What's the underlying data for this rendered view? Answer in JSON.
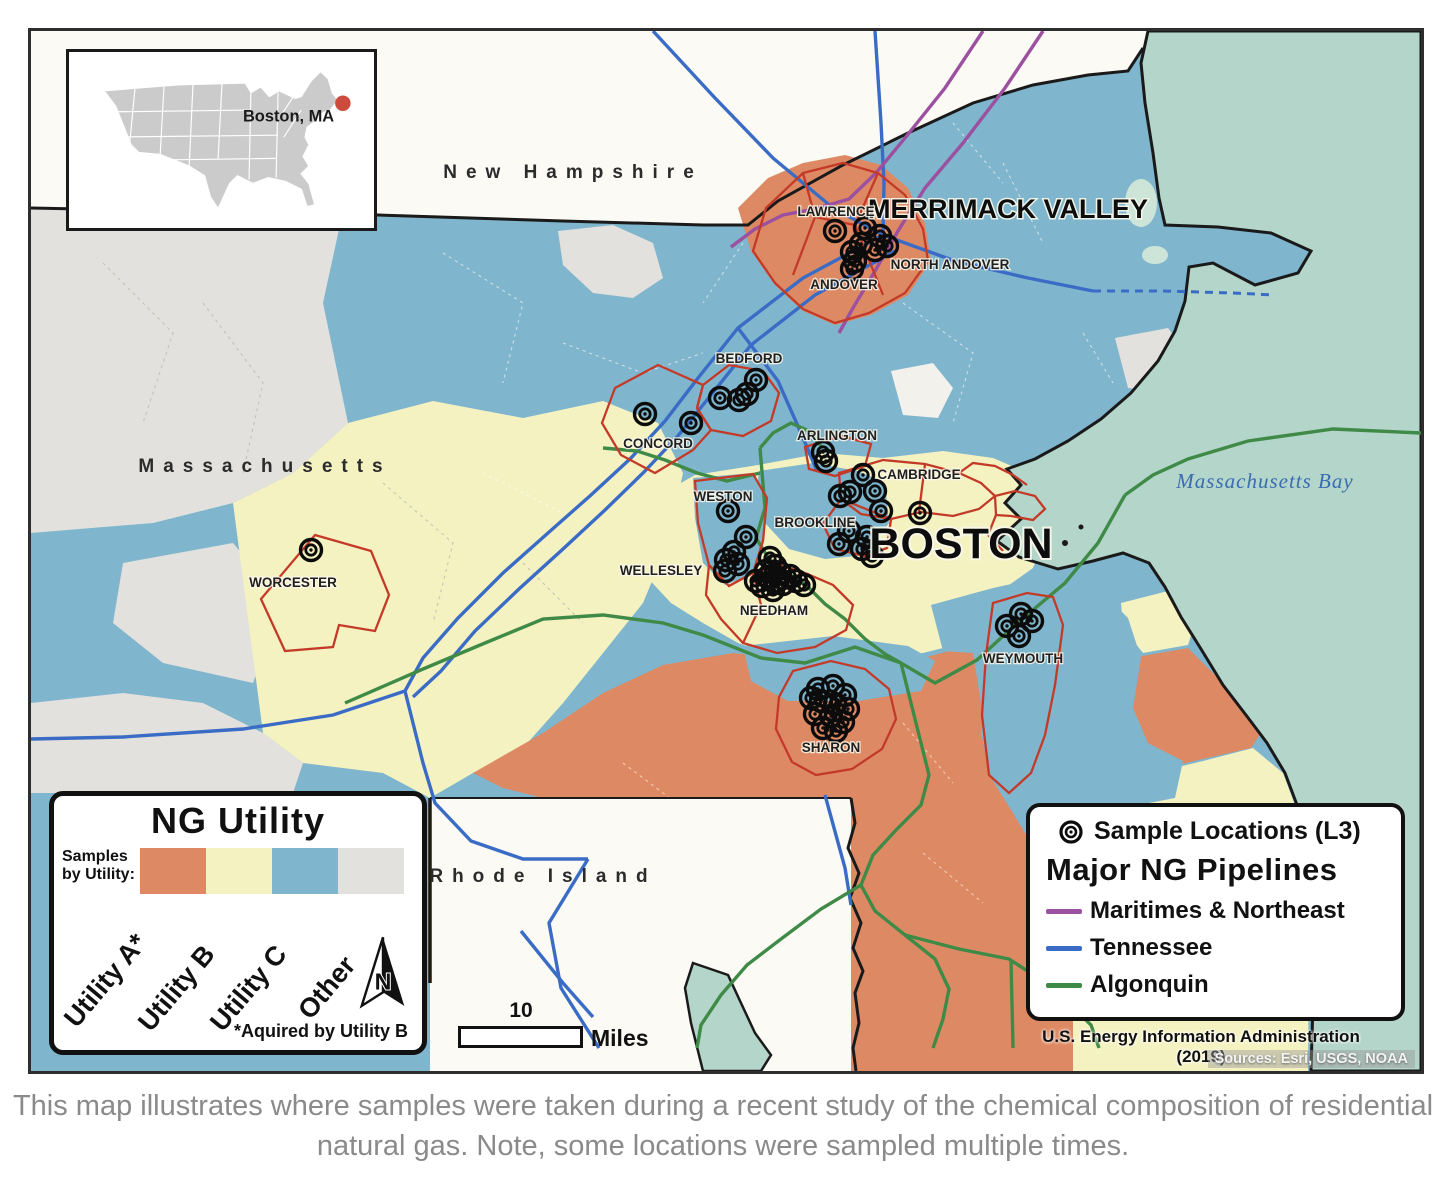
{
  "map": {
    "inset": {
      "label": "Boston, MA",
      "dot_color": "#CC4B3C"
    },
    "states": {
      "new_hampshire": "New Hampshire",
      "massachusetts": "Massachusetts",
      "rhode_island": "Rhode Island"
    },
    "water_label": "Massachusetts Bay",
    "areas": {
      "merrimack_valley": "MERRIMACK VALLEY",
      "boston": "BOSTON"
    },
    "towns": {
      "lawrence": "LAWRENCE",
      "north_andover": "NORTH ANDOVER",
      "andover": "ANDOVER",
      "bedford": "BEDFORD",
      "concord": "CONCORD",
      "arlington": "ARLINGTON",
      "cambridge": "CAMBRIDGE",
      "weston": "WESTON",
      "brookline": "BROOKLINE",
      "wellesley": "WELLESLEY",
      "needham": "NEEDHAM",
      "worcester": "WORCESTER",
      "weymouth": "WEYMOUTH",
      "sharon": "SHARON"
    },
    "region_colors": {
      "utility_a": "#DD8A64",
      "utility_b": "#F5F2C2",
      "utility_c": "#7FB5CD",
      "other": "#E2E1DD",
      "water": "#B4D5CA",
      "outside": "#FBFAF5",
      "sample_region_outline": "#C43A28"
    },
    "sample_points": [
      [
        832,
        228
      ],
      [
        862,
        225
      ],
      [
        877,
        233
      ],
      [
        858,
        241
      ],
      [
        872,
        247
      ],
      [
        884,
        243
      ],
      [
        849,
        249
      ],
      [
        852,
        258
      ],
      [
        849,
        266
      ],
      [
        753,
        377
      ],
      [
        744,
        391
      ],
      [
        736,
        397
      ],
      [
        717,
        395
      ],
      [
        688,
        420
      ],
      [
        642,
        411
      ],
      [
        820,
        449
      ],
      [
        823,
        458
      ],
      [
        860,
        472
      ],
      [
        872,
        488
      ],
      [
        847,
        489
      ],
      [
        837,
        493
      ],
      [
        878,
        508
      ],
      [
        917,
        510
      ],
      [
        846,
        528
      ],
      [
        864,
        534
      ],
      [
        859,
        546
      ],
      [
        869,
        553
      ],
      [
        836,
        541
      ],
      [
        725,
        508
      ],
      [
        743,
        534
      ],
      [
        731,
        549
      ],
      [
        723,
        557
      ],
      [
        735,
        561
      ],
      [
        722,
        568
      ],
      [
        767,
        555
      ],
      [
        772,
        563
      ],
      [
        777,
        570
      ],
      [
        765,
        574
      ],
      [
        772,
        579
      ],
      [
        780,
        581
      ],
      [
        787,
        573
      ],
      [
        793,
        578
      ],
      [
        770,
        587
      ],
      [
        759,
        583
      ],
      [
        753,
        578
      ],
      [
        763,
        568
      ],
      [
        801,
        582
      ],
      [
        308,
        547
      ],
      [
        1018,
        611
      ],
      [
        1004,
        623
      ],
      [
        1016,
        633
      ],
      [
        1029,
        618
      ],
      [
        815,
        686
      ],
      [
        830,
        683
      ],
      [
        842,
        692
      ],
      [
        818,
        698
      ],
      [
        832,
        701
      ],
      [
        845,
        706
      ],
      [
        812,
        711
      ],
      [
        828,
        713
      ],
      [
        840,
        719
      ],
      [
        820,
        725
      ],
      [
        833,
        728
      ],
      [
        808,
        695
      ]
    ]
  },
  "legend_utility": {
    "title": "NG Utility",
    "samples_label": "Samples by Utility:",
    "items": [
      {
        "label": "Utility A*",
        "color": "#DD8A64"
      },
      {
        "label": "Utility B",
        "color": "#F5F2C2"
      },
      {
        "label": "Utility C",
        "color": "#7FB5CD"
      },
      {
        "label": "Other",
        "color": "#E2E1DD"
      }
    ],
    "footnote": "*Aquired by Utility B",
    "north_arrow_letter": "N"
  },
  "legend_pipelines": {
    "sample_locations_label": "Sample Locations (L3)",
    "title": "Major NG Pipelines",
    "items": [
      {
        "label": "Maritimes & Northeast",
        "color": "#9C50A0"
      },
      {
        "label": "Tennessee",
        "color": "#3A6CC6"
      },
      {
        "label": "Algonquin",
        "color": "#3F8A47"
      }
    ]
  },
  "scalebar": {
    "value": "10",
    "unit": "Miles"
  },
  "attribution": {
    "source": "U.S. Energy Information Administration (2019)",
    "credits": "Sources: Esri, USGS, NOAA"
  },
  "caption": "This map illustrates where samples were taken during a recent study of the chemical composition of residential natural gas. Note, some locations were sampled multiple times."
}
